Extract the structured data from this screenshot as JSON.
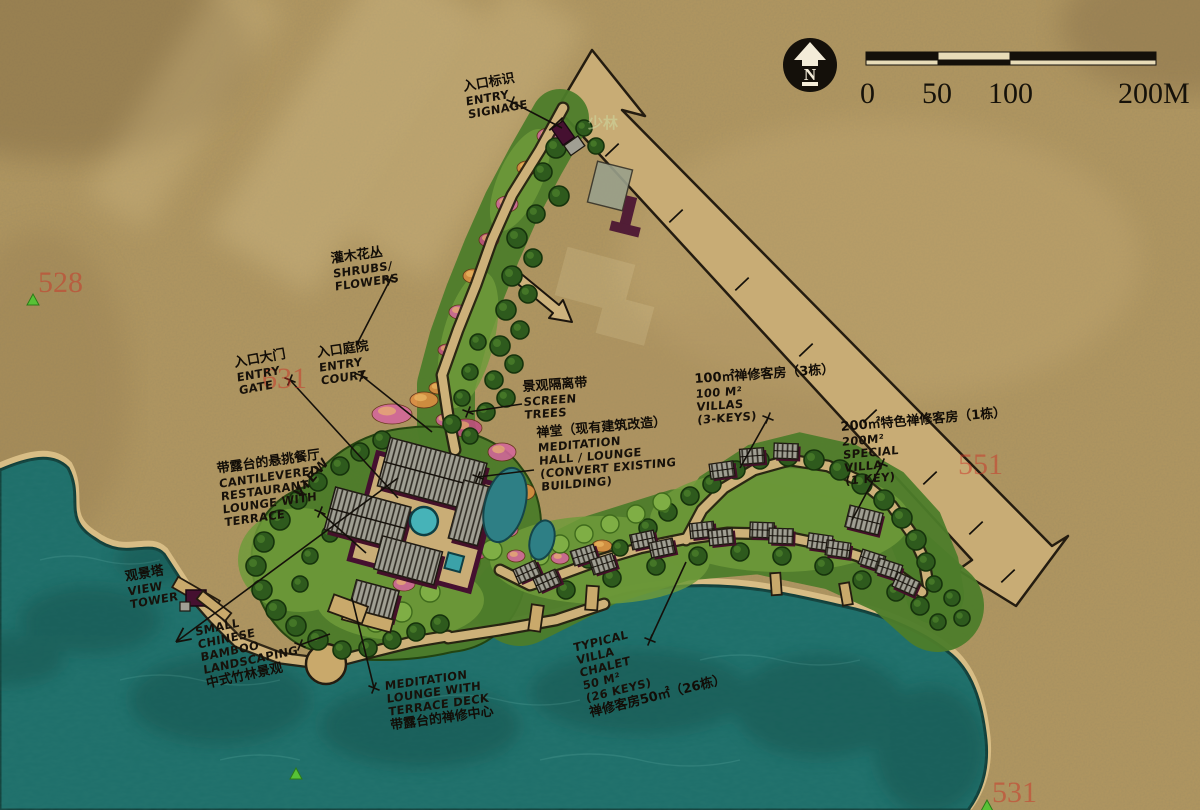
{
  "compass": {
    "label": "N"
  },
  "scale_bar": {
    "labels": [
      "0",
      "50",
      "100",
      "200M"
    ]
  },
  "annotations": [
    {
      "id": "entry-signage",
      "cn": "入口标识",
      "en": [
        "ENTRY",
        "SIGNAGE"
      ],
      "x": 462,
      "y": 80,
      "rot": -10
    },
    {
      "id": "shrubs-flowers",
      "cn": "灌木花丛",
      "en": [
        "SHRUBS/",
        "FLOWERS"
      ],
      "x": 330,
      "y": 252,
      "rot": -8
    },
    {
      "id": "entry-gate",
      "cn": "入口大门",
      "en": [
        "ENTRY",
        "GATE"
      ],
      "x": 233,
      "y": 356,
      "rot": -10
    },
    {
      "id": "entry-court",
      "cn": "入口庭院",
      "en": [
        "ENTRY",
        "COURT"
      ],
      "x": 316,
      "y": 346,
      "rot": -8
    },
    {
      "id": "screen-trees",
      "cn": "景观隔离带",
      "en": [
        "SCREEN",
        "TREES"
      ],
      "x": 522,
      "y": 380,
      "rot": -4
    },
    {
      "id": "meditation-hall",
      "cn": "禅堂（现有建筑改造）",
      "en": [
        "MEDITATION",
        "HALL / LOUNGE",
        "(CONVERT EXISTING",
        "BUILDING)"
      ],
      "x": 536,
      "y": 426,
      "rot": -5
    },
    {
      "id": "villas-100",
      "cn": "100㎡禅修客房（3栋）",
      "en": [
        "100 M²",
        "VILLAS",
        "(3-KEYS)"
      ],
      "x": 694,
      "y": 372,
      "rot": -4
    },
    {
      "id": "special-villa",
      "cn": "200㎡特色禅修客房（1栋）",
      "en": [
        "200M²",
        "SPECIAL",
        "VILLA",
        "(1 KEY)"
      ],
      "x": 840,
      "y": 420,
      "rot": -5
    },
    {
      "id": "restaurant",
      "cn": "带露台的悬挑餐厅",
      "en": [
        "CANTILEVERED",
        "RESTAURANT",
        "LOUNGE WITH",
        "TERRACE"
      ],
      "x": 216,
      "y": 462,
      "rot": -8
    },
    {
      "id": "view-axis",
      "cn": "",
      "en": [
        "VIEW"
      ],
      "x": 292,
      "y": 492,
      "rot": -50
    },
    {
      "id": "view-tower",
      "cn": "观景塔",
      "en": [
        "VIEW",
        "TOWER"
      ],
      "x": 124,
      "y": 570,
      "rot": -10
    },
    {
      "id": "bamboo",
      "cn": "",
      "en": [
        "SMALL",
        "CHINESE",
        "BAMBOO",
        "LANDSCAPING"
      ],
      "cn_after": "中式竹林景观",
      "x": 194,
      "y": 626,
      "rot": -12
    },
    {
      "id": "meditation-lounge",
      "cn": "",
      "en": [
        "MEDITATION",
        "LOUNGE WITH",
        "TERRACE DECK"
      ],
      "cn_after": "带露台的禅修中心",
      "x": 384,
      "y": 680,
      "rot": -8
    },
    {
      "id": "typical-villa",
      "cn": "",
      "en": [
        "TYPICAL",
        "VILLA",
        "CHALET",
        "50 M²",
        "(26 KEYS)"
      ],
      "cn_after": "禅修客房50㎡（26栋）",
      "x": 572,
      "y": 642,
      "rot": -14
    }
  ],
  "watermarks": {
    "red_numbers": [
      {
        "t": "528",
        "x": 38,
        "y": 292
      },
      {
        "t": "631",
        "x": 262,
        "y": 388
      },
      {
        "t": "551",
        "x": 958,
        "y": 474
      },
      {
        "t": "531",
        "x": 992,
        "y": 802
      }
    ],
    "green_triangles": [
      [
        33,
        300
      ],
      [
        296,
        774
      ],
      [
        987,
        806
      ]
    ],
    "ghost_text": {
      "t": "少林",
      "x": 588,
      "y": 128
    }
  },
  "map": {
    "leaders": [
      {
        "pts": [
          [
            512,
            102
          ],
          [
            562,
            128
          ]
        ],
        "tick": "start"
      },
      {
        "pts": [
          [
            390,
            280
          ],
          [
            356,
            346
          ]
        ],
        "tick": "start"
      },
      {
        "pts": [
          [
            290,
            380
          ],
          [
            398,
            498
          ]
        ],
        "tick": "start"
      },
      {
        "pts": [
          [
            362,
            376
          ],
          [
            432,
            432
          ]
        ],
        "tick": "start"
      },
      {
        "pts": [
          [
            522,
            404
          ],
          [
            468,
            412
          ]
        ],
        "tick": "end"
      },
      {
        "pts": [
          [
            534,
            470
          ],
          [
            478,
            477
          ]
        ],
        "tick": "end"
      },
      {
        "pts": [
          [
            768,
            418
          ],
          [
            740,
            468
          ]
        ],
        "tick": "start"
      },
      {
        "pts": [
          [
            882,
            464
          ],
          [
            852,
            520
          ]
        ],
        "tick": "start"
      },
      {
        "pts": [
          [
            320,
            512
          ],
          [
            366,
            553
          ]
        ],
        "tick": "start"
      },
      {
        "pts": [
          [
            300,
            645
          ],
          [
            330,
            634
          ]
        ],
        "tick": "start"
      },
      {
        "pts": [
          [
            352,
            598
          ],
          [
            374,
            688
          ]
        ],
        "tick": "end"
      },
      {
        "pts": [
          [
            686,
            562
          ],
          [
            650,
            640
          ]
        ],
        "tick": "end"
      },
      {
        "pts": [
          [
            398,
            478
          ],
          [
            176,
            642
          ]
        ],
        "arrow": true
      }
    ],
    "road_ticks": [
      [
        612,
        150
      ],
      [
        676,
        216
      ],
      [
        742,
        284
      ],
      [
        806,
        350
      ],
      [
        870,
        416
      ],
      [
        930,
        478
      ],
      [
        976,
        528
      ],
      [
        556,
        124
      ],
      [
        1008,
        576
      ]
    ],
    "trees": [
      [
        556,
        148,
        10
      ],
      [
        543,
        172,
        9
      ],
      [
        559,
        196,
        10
      ],
      [
        536,
        214,
        9
      ],
      [
        517,
        238,
        10
      ],
      [
        533,
        258,
        9
      ],
      [
        512,
        276,
        10
      ],
      [
        528,
        294,
        9
      ],
      [
        506,
        310,
        10
      ],
      [
        520,
        330,
        9
      ],
      [
        500,
        346,
        10
      ],
      [
        514,
        364,
        9
      ],
      [
        494,
        380,
        9
      ],
      [
        506,
        398,
        9
      ],
      [
        486,
        412,
        9
      ],
      [
        470,
        372,
        8
      ],
      [
        478,
        342,
        8
      ],
      [
        462,
        398,
        8
      ],
      [
        452,
        424,
        9
      ],
      [
        470,
        436,
        8
      ],
      [
        584,
        128,
        8
      ],
      [
        596,
        146,
        8
      ],
      [
        382,
        440,
        9
      ],
      [
        360,
        452,
        9
      ],
      [
        340,
        466,
        9
      ],
      [
        318,
        482,
        9
      ],
      [
        298,
        500,
        9
      ],
      [
        280,
        520,
        10
      ],
      [
        264,
        542,
        10
      ],
      [
        256,
        566,
        10
      ],
      [
        262,
        590,
        10
      ],
      [
        276,
        610,
        10
      ],
      [
        296,
        626,
        10
      ],
      [
        318,
        640,
        10
      ],
      [
        342,
        650,
        9
      ],
      [
        368,
        648,
        9
      ],
      [
        392,
        640,
        9
      ],
      [
        416,
        632,
        9
      ],
      [
        440,
        624,
        9
      ],
      [
        330,
        534,
        8
      ],
      [
        310,
        556,
        8
      ],
      [
        346,
        610,
        8
      ],
      [
        300,
        584,
        8
      ],
      [
        566,
        590,
        9
      ],
      [
        612,
        578,
        9
      ],
      [
        656,
        566,
        9
      ],
      [
        698,
        556,
        9
      ],
      [
        740,
        552,
        9
      ],
      [
        782,
        556,
        9
      ],
      [
        824,
        566,
        9
      ],
      [
        862,
        580,
        9
      ],
      [
        896,
        592,
        9
      ],
      [
        920,
        606,
        9
      ],
      [
        938,
        622,
        8
      ],
      [
        648,
        528,
        9
      ],
      [
        668,
        512,
        9
      ],
      [
        690,
        496,
        9
      ],
      [
        712,
        484,
        9
      ],
      [
        736,
        470,
        9
      ],
      [
        760,
        460,
        9
      ],
      [
        788,
        456,
        10
      ],
      [
        814,
        460,
        10
      ],
      [
        840,
        470,
        10
      ],
      [
        862,
        484,
        10
      ],
      [
        884,
        500,
        10
      ],
      [
        902,
        518,
        10
      ],
      [
        916,
        540,
        10
      ],
      [
        926,
        562,
        9
      ],
      [
        934,
        584,
        8
      ],
      [
        952,
        598,
        8
      ],
      [
        962,
        618,
        8
      ],
      [
        620,
        548,
        8
      ],
      [
        588,
        560,
        8
      ]
    ],
    "light_trees": [
      [
        448,
        576,
        11
      ],
      [
        470,
        562,
        10
      ],
      [
        492,
        550,
        10
      ],
      [
        430,
        592,
        10
      ],
      [
        560,
        544,
        9
      ],
      [
        584,
        534,
        9
      ],
      [
        610,
        524,
        9
      ],
      [
        636,
        514,
        9
      ],
      [
        540,
        556,
        9
      ],
      [
        662,
        502,
        9
      ],
      [
        402,
        612,
        10
      ],
      [
        376,
        622,
        10
      ]
    ],
    "flowers": [
      [
        549,
        136,
        12,
        8,
        "#d4679b"
      ],
      [
        527,
        168,
        10,
        7,
        "#df8f43"
      ],
      [
        507,
        204,
        11,
        8,
        "#d4679b"
      ],
      [
        489,
        240,
        10,
        7,
        "#c14f80"
      ],
      [
        473,
        276,
        10,
        7,
        "#df8f43"
      ],
      [
        459,
        312,
        10,
        7,
        "#d4679b"
      ],
      [
        447,
        350,
        9,
        6,
        "#c14f80"
      ],
      [
        438,
        388,
        9,
        6,
        "#df8f43"
      ],
      [
        444,
        420,
        8,
        6,
        "#d4679b"
      ],
      [
        392,
        414,
        20,
        10,
        "#d4679b"
      ],
      [
        424,
        400,
        14,
        8,
        "#df8f43"
      ],
      [
        466,
        428,
        16,
        9,
        "#c14f80"
      ],
      [
        502,
        452,
        14,
        9,
        "#d4679b"
      ],
      [
        524,
        492,
        11,
        8,
        "#df8f43"
      ],
      [
        508,
        530,
        10,
        7,
        "#d4679b"
      ],
      [
        478,
        552,
        10,
        7,
        "#c14f80"
      ],
      [
        440,
        568,
        12,
        8,
        "#df8f43"
      ],
      [
        404,
        584,
        11,
        7,
        "#d4679b"
      ],
      [
        372,
        598,
        10,
        7,
        "#c14f80"
      ],
      [
        516,
        556,
        9,
        6,
        "#d4679b"
      ],
      [
        602,
        546,
        10,
        6,
        "#df8f43"
      ],
      [
        560,
        558,
        9,
        6,
        "#d4679b"
      ]
    ],
    "villas": [
      [
        527,
        572,
        -24
      ],
      [
        547,
        581,
        -24
      ],
      [
        584,
        555,
        -18
      ],
      [
        603,
        564,
        -18
      ],
      [
        643,
        540,
        -12
      ],
      [
        662,
        548,
        -12
      ],
      [
        702,
        530,
        -6
      ],
      [
        721,
        537,
        -6
      ],
      [
        762,
        530,
        2
      ],
      [
        781,
        536,
        2
      ],
      [
        820,
        542,
        8
      ],
      [
        838,
        549,
        8
      ],
      [
        872,
        560,
        18
      ],
      [
        889,
        569,
        18
      ],
      [
        906,
        584,
        24
      ],
      [
        722,
        470,
        -8
      ],
      [
        752,
        456,
        -4
      ],
      [
        786,
        451,
        2
      ]
    ],
    "special_villa": [
      864,
      520,
      14
    ],
    "piers": [
      [
        214,
        606,
        36,
        10,
        38
      ],
      [
        536,
        618,
        12,
        26,
        8
      ],
      [
        592,
        598,
        12,
        24,
        4
      ],
      [
        776,
        584,
        10,
        22,
        -4
      ],
      [
        846,
        594,
        10,
        22,
        -10
      ]
    ]
  }
}
